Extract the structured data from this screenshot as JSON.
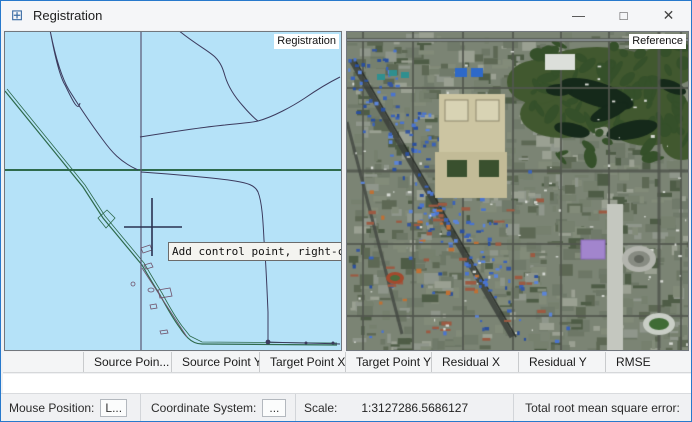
{
  "window": {
    "title": "Registration",
    "icon_glyph": "⊞",
    "controls": {
      "minimize": "—",
      "maximize": "□",
      "close": "✕"
    }
  },
  "panels": {
    "left": {
      "label": "Registration",
      "type": "vector-map"
    },
    "right": {
      "label": "Reference",
      "type": "satellite-map"
    },
    "tooltip": "Add control point, right-cli"
  },
  "table": {
    "columns": [
      "",
      "Source Poin...",
      "Source Point Y",
      "Target Point X",
      "Target Point Y",
      "Residual X",
      "Residual Y",
      "RMSE"
    ],
    "rows": []
  },
  "status_bar": {
    "mouse_position_label": "Mouse Position:",
    "mouse_position_value": "L...",
    "coordinate_system_label": "Coordinate System:",
    "coordinate_system_value": "...",
    "scale_label": "Scale:",
    "scale_value": "1:3127286.5686127",
    "total_rmse_label": "Total root mean square error:",
    "total_rmse_value": ""
  },
  "colors": {
    "window_border": "#2779cc",
    "titlebar_bg": "#f5f6f8",
    "map_background": "#b5e2f8",
    "map_green_line": "#2e6a4c",
    "map_navy_line": "#3c3b5e",
    "map_slate_line": "#5a5674",
    "map_purple_detail": "#70526b",
    "crosshair": "#2a3150",
    "satellite_base": "#7b8474",
    "satellite_park": "#41582f",
    "satellite_lake": "#15291a"
  }
}
